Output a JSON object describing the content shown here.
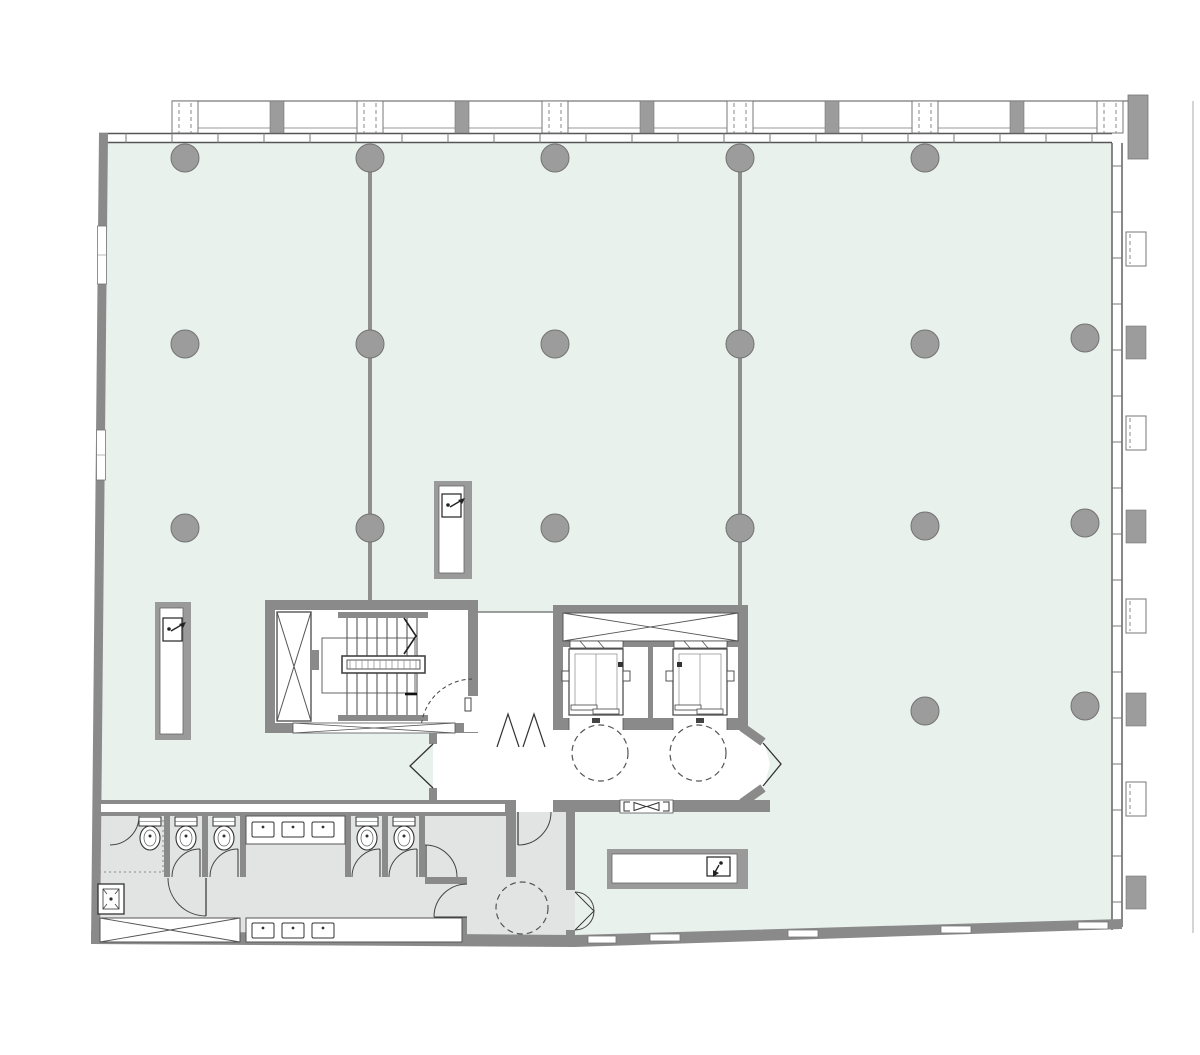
{
  "meta": {
    "title": "Office floor plan",
    "description": "Architectural floor plan: open office area, stair core, two elevators with lobby, restroom suite, curtain-wall facade",
    "canvas_width": 1200,
    "canvas_height": 1055
  },
  "palette": {
    "floor": "#e9f1ed",
    "wet_area_floor": "#e2e4e3",
    "wall": "#8a8a8a",
    "pier": "#9c9c9c",
    "column_fill": "#9c9c9c",
    "column_stroke": "#737373",
    "line_dark": "#444444",
    "line_mid": "#666666",
    "line_light": "#8f8f8f",
    "white": "#ffffff",
    "dash": "#555555"
  },
  "column_grid": {
    "radius": 14,
    "columns": [
      [
        185,
        158
      ],
      [
        370,
        158
      ],
      [
        555,
        158
      ],
      [
        740,
        158
      ],
      [
        925,
        158
      ],
      [
        185,
        344
      ],
      [
        370,
        344
      ],
      [
        555,
        344
      ],
      [
        740,
        344
      ],
      [
        925,
        344
      ],
      [
        1085,
        338
      ],
      [
        185,
        528
      ],
      [
        370,
        528
      ],
      [
        555,
        528
      ],
      [
        740,
        528
      ],
      [
        925,
        526
      ],
      [
        1085,
        523
      ],
      [
        925,
        711
      ],
      [
        1085,
        706
      ]
    ]
  },
  "grid_lines": [
    {
      "x": 370,
      "y1": 158,
      "y2": 600
    },
    {
      "x": 740,
      "y1": 158,
      "y2": 605
    }
  ],
  "facade_top": {
    "band_line_y": 101,
    "band_inner_line_y": 128,
    "pier_top": 101,
    "pier_height": 32,
    "solid_pier_xs": [
      277,
      462,
      647,
      832,
      1017
    ],
    "glazed_pier_xs": [
      185,
      370,
      555,
      740,
      925,
      1110
    ]
  },
  "facade_right": {
    "x": 1126,
    "width": 20,
    "solid_pier_ys": [
      326,
      510,
      693,
      876
    ],
    "glazed_pier_ys": [
      232,
      416,
      599,
      782
    ],
    "corner_block": [
      1128,
      95,
      20,
      64
    ],
    "boundary_line_x": 1193
  },
  "mullion_ticks": {
    "top_wall": {
      "y1": 133,
      "y2": 143,
      "x_start": 126,
      "x_end": 1104,
      "step": 46
    },
    "right_wall": {
      "x1": 1112,
      "x2": 1122,
      "y_start": 166,
      "y_end": 912,
      "step": 46
    }
  },
  "clearance_circles": [
    {
      "cx": 600,
      "cy": 753,
      "r": 28
    },
    {
      "cx": 698,
      "cy": 753,
      "r": 28
    },
    {
      "cx": 522,
      "cy": 908,
      "r": 26
    }
  ],
  "fixtures": {
    "toilet_cx_list": [
      150,
      186,
      224,
      367,
      404
    ],
    "toilet_top_y": 817,
    "sink_top_xs": [
      252,
      282,
      312
    ],
    "sink_top_y": 822,
    "sink_bottom_xs": [
      252,
      282,
      312
    ],
    "sink_bottom_y": 923
  },
  "cores": {
    "stair": {
      "name": "stair-core",
      "tread_count": 8,
      "tread_x_start": 347,
      "tread_x_step": 10
    },
    "elevator": {
      "name": "elevator-core",
      "cars": 2
    }
  },
  "restroom_summary": {
    "accessible_wc": 1,
    "standard_stalls": 4,
    "sinks": 6,
    "mop_sink": 1
  },
  "cabinets": [
    {
      "name": "hose-reel-cabinet-west"
    },
    {
      "name": "hose-reel-cabinet-center"
    },
    {
      "name": "hose-reel-cabinet-south"
    }
  ]
}
